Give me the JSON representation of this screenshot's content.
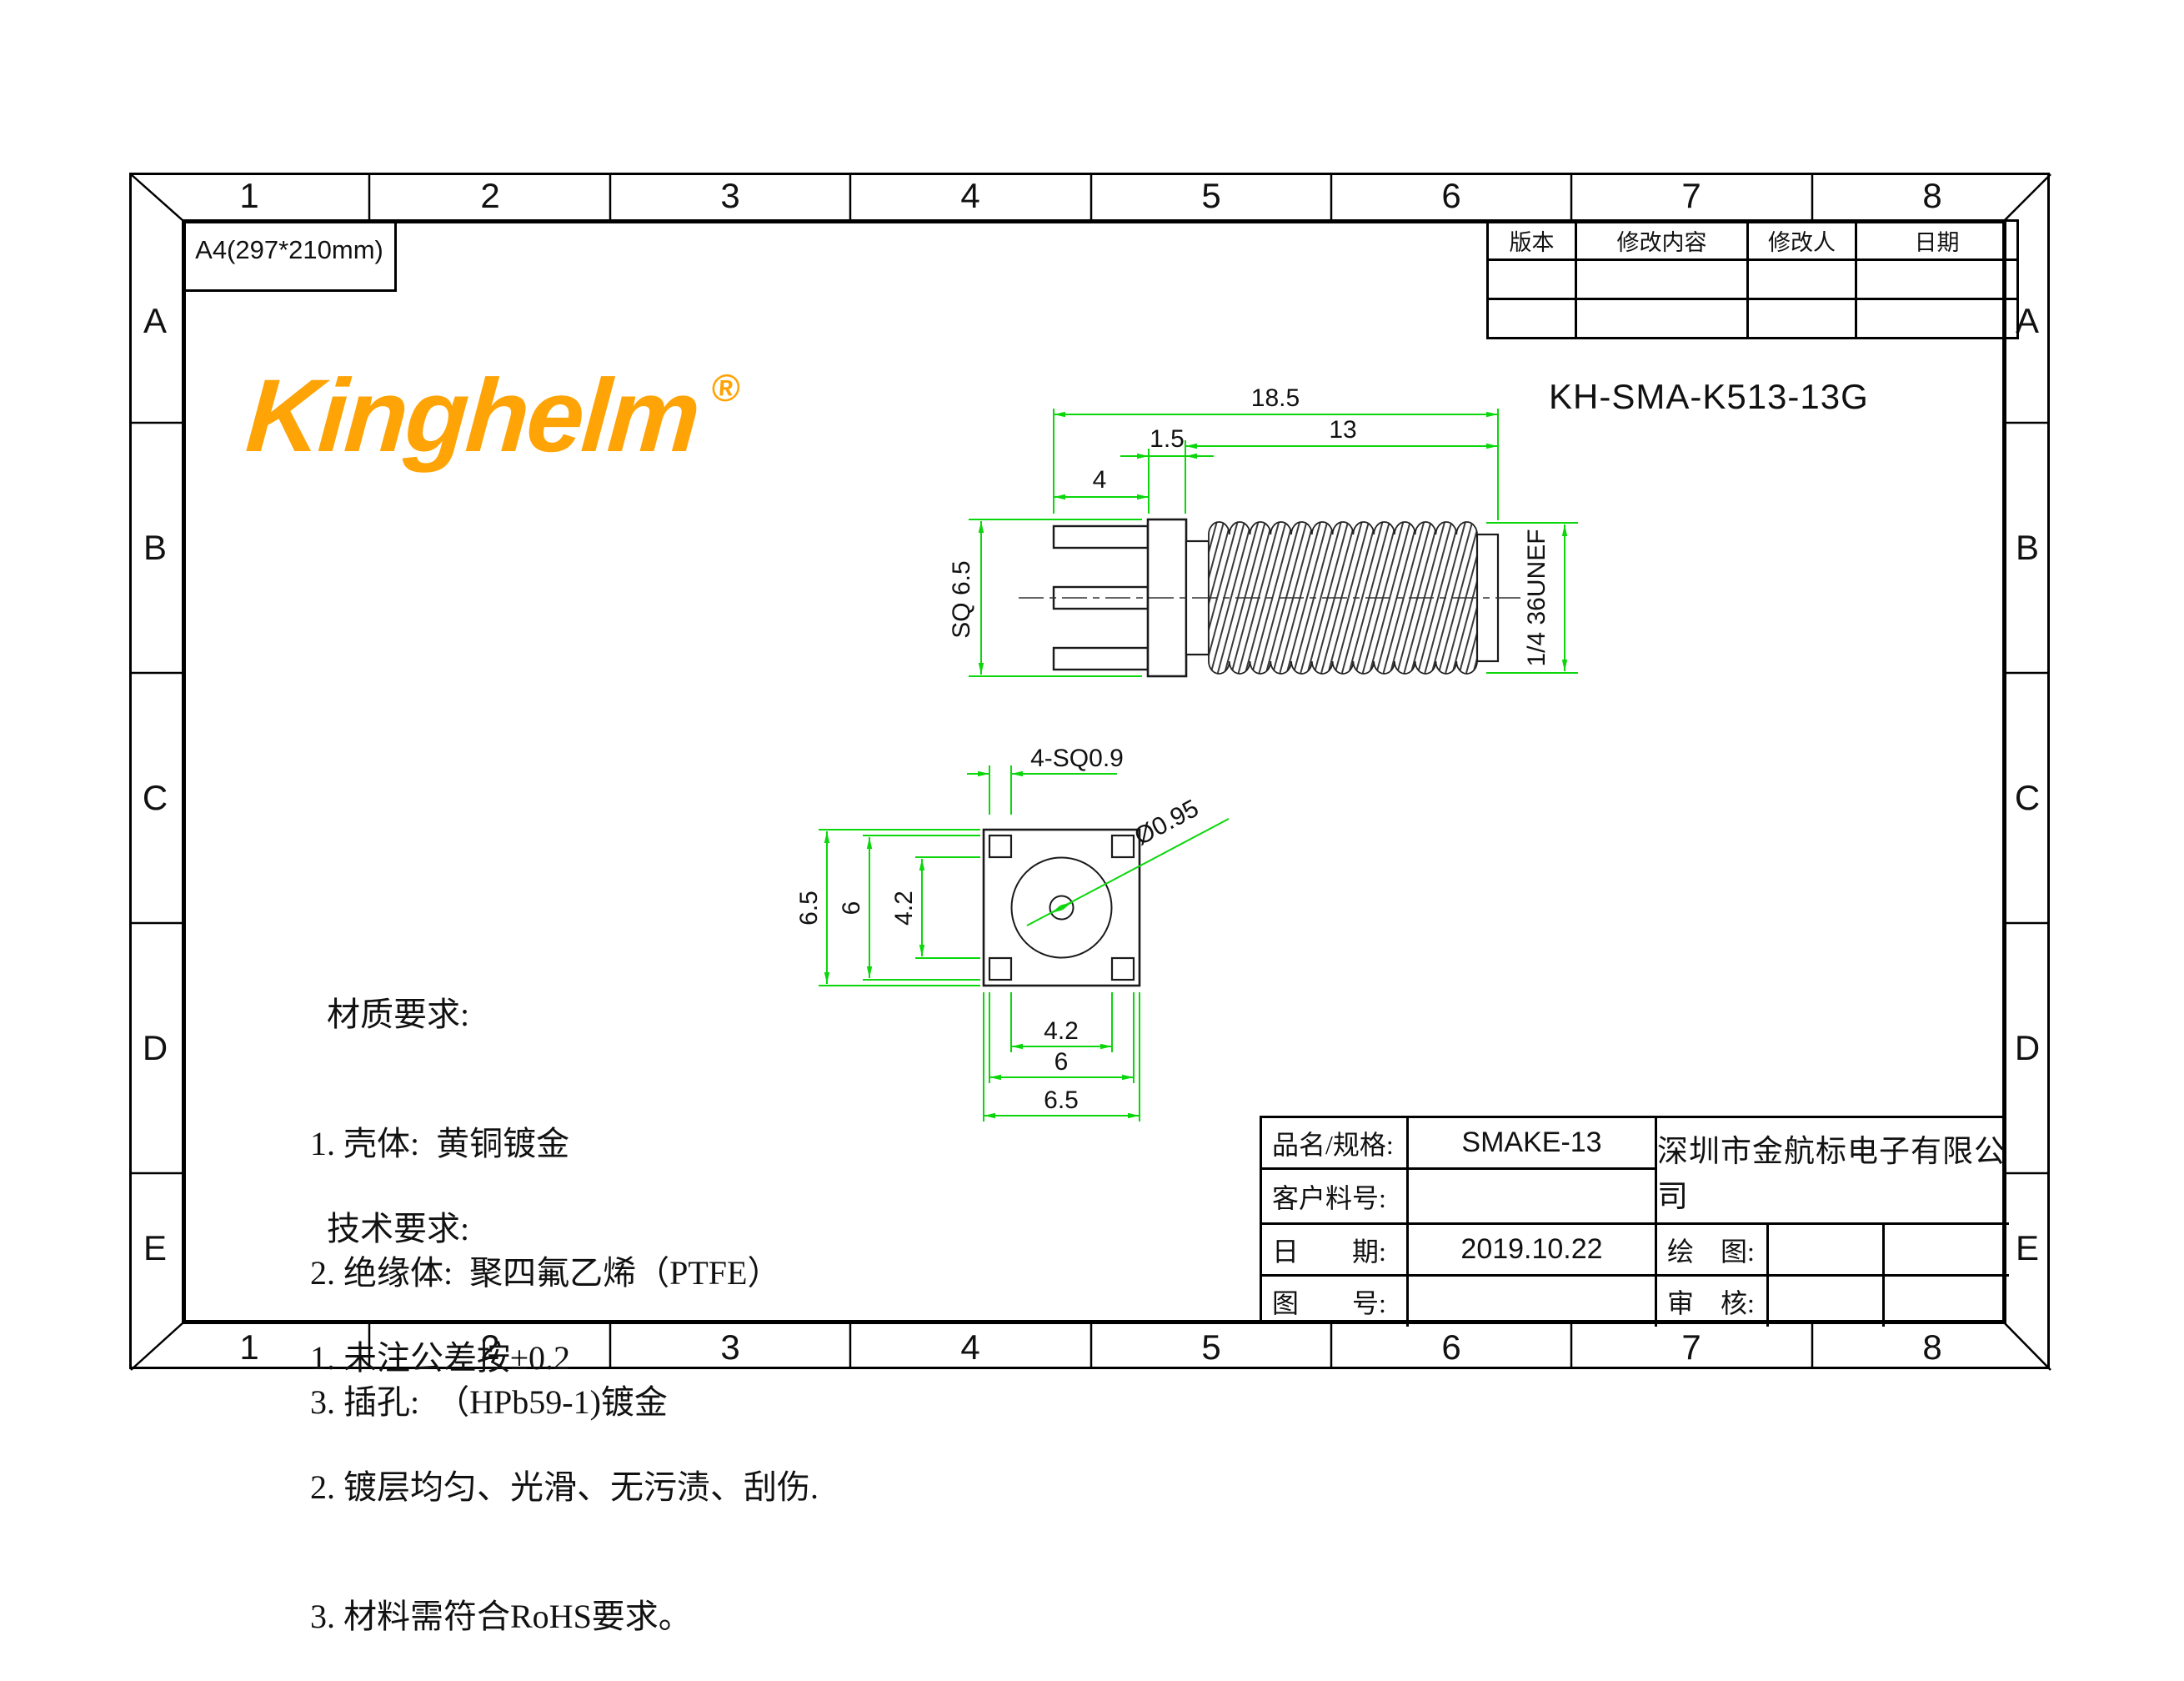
{
  "frame": {
    "columns": [
      "1",
      "2",
      "3",
      "4",
      "5",
      "6",
      "7",
      "8"
    ],
    "rows": [
      "A",
      "B",
      "C",
      "D",
      "E"
    ],
    "sheet_size": "A4(297*210mm)"
  },
  "logo": {
    "text": "Kinghelm",
    "registered": "®"
  },
  "part_number": "KH-SMA-K513-13G",
  "revision_table": {
    "headers": [
      "版本",
      "修改内容",
      "修改人",
      "日期"
    ],
    "rows": [
      [
        "",
        "",
        "",
        ""
      ],
      [
        "",
        "",
        "",
        ""
      ]
    ]
  },
  "side_view": {
    "dim_total": "18.5",
    "dim_thread_len": "13",
    "dim_flange_thk": "1.5",
    "dim_pin_len": "4",
    "dim_flange_sq": "SQ 6.5",
    "dim_thread_spec": "1/4 36UNEF"
  },
  "front_view": {
    "dim_corner_pins": "4-SQ0.9",
    "dim_center_hole": "Ø0.95",
    "dim_left_outer": "6.5",
    "dim_left_mid": "6",
    "dim_left_inner": "4.2",
    "dim_bottom_inner": "4.2",
    "dim_bottom_mid": "6",
    "dim_bottom_outer": "6.5"
  },
  "notes": {
    "material": {
      "title": "材质要求:",
      "item1": "1. 壳体:  黄铜镀金",
      "item2": "2. 绝缘体:  聚四氟乙烯（PTFE）",
      "item3": "3. 插孔:  （HPb59-1)镀金"
    },
    "technical": {
      "title": "技术要求:",
      "item1": "1. 未注公差按±0.2",
      "item2": "2. 镀层均匀、光滑、无污渍、刮伤.",
      "item3": "3. 材料需符合RoHS要求。"
    }
  },
  "title_block": {
    "product_label": "品名/规格:",
    "product_value": "SMAKE-13",
    "customer_label": "客户料号:",
    "customer_value": "",
    "date_label": "日　　期:",
    "date_value": "2019.10.22",
    "drawing_no_label": "图　　号:",
    "drawing_no_value": "",
    "company": "深圳市金航标电子有限公司",
    "draw_label": "绘　图:",
    "draw_value": "",
    "audit_label": "审　核:",
    "audit_value": ""
  },
  "colors": {
    "logo_orange": "#FFA407",
    "dimension_green": "#0BD60B",
    "line_black": "#1A1A1A"
  }
}
